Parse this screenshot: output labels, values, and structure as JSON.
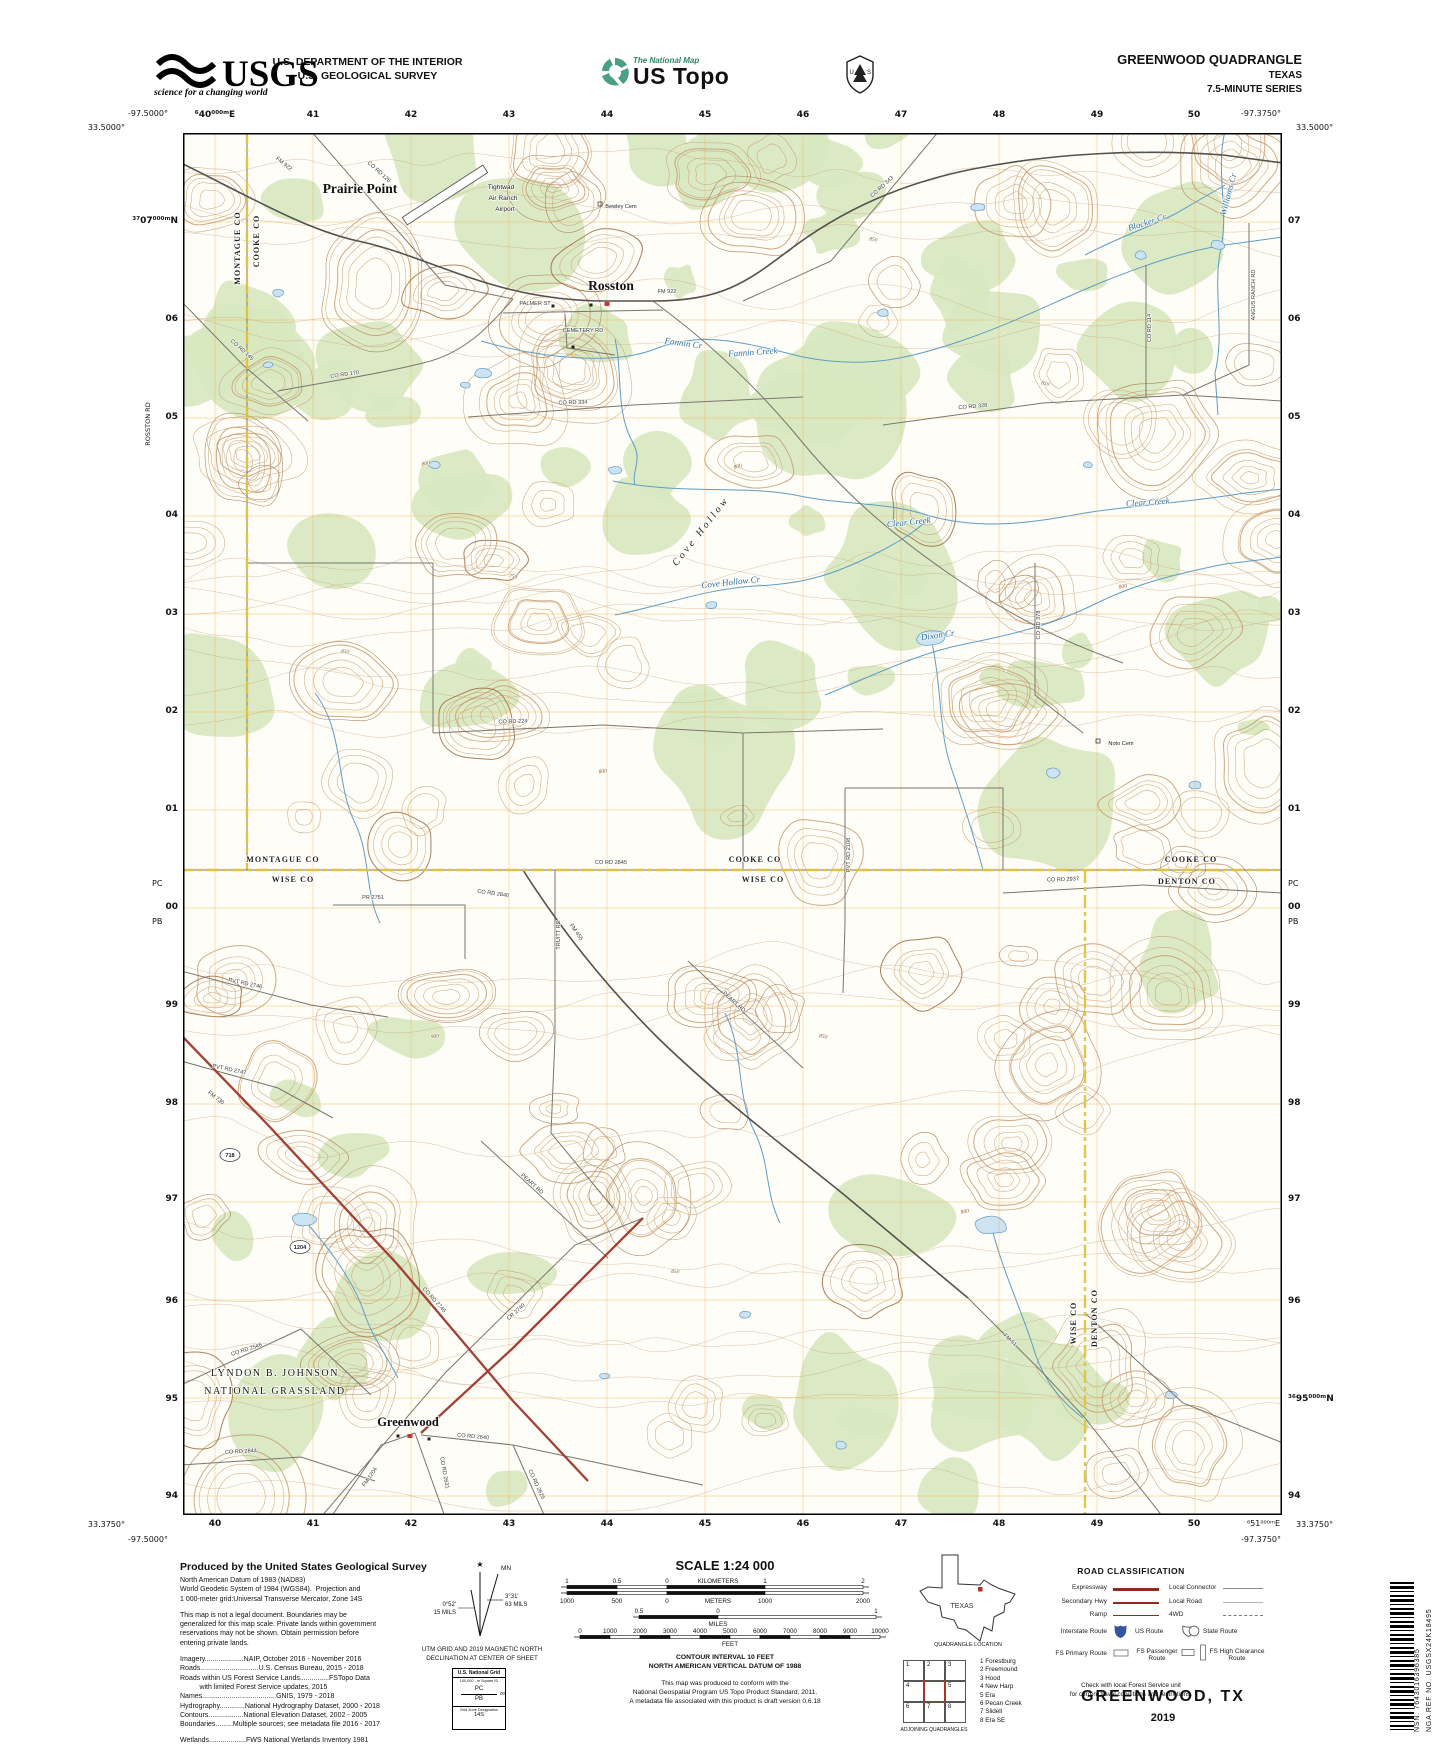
{
  "header": {
    "usgs_wordmark": "USGS",
    "usgs_tagline": "science for a changing world",
    "dept1": "U.S. DEPARTMENT OF THE INTERIOR",
    "dept2": "U.S. GEOLOGICAL SURVEY",
    "natmap_title": "The National Map",
    "natmap_sub": "US Topo",
    "fs_u": "U",
    "fs_s": "S",
    "quad": "GREENWOOD QUADRANGLE",
    "state": "TEXAS",
    "series": "7.5-MINUTE SERIES"
  },
  "collar": {
    "corners": {
      "tl_lat": "33.5000°",
      "tl_lon": "-97.5000°",
      "tr_lat": "33.5000°",
      "tr_lon": "-97.3750°",
      "bl_lat": "33.3750°",
      "bl_lon": "-97.5000°",
      "br_lat": "33.3750°",
      "br_lon": "-97.3750°",
      "br_grid": "⁶51⁰⁰⁰ᵐE"
    },
    "pc": "PC",
    "pb": "PB",
    "rosston_rd": "ROSSTON RD",
    "top": [
      {
        "t": "⁶40⁰⁰⁰ᵐE",
        "x": 215
      },
      {
        "t": "41",
        "x": 313
      },
      {
        "t": "42",
        "x": 411
      },
      {
        "t": "43",
        "x": 509
      },
      {
        "t": "44",
        "x": 607
      },
      {
        "t": "45",
        "x": 705
      },
      {
        "t": "46",
        "x": 803
      },
      {
        "t": "47",
        "x": 901
      },
      {
        "t": "48",
        "x": 999
      },
      {
        "t": "49",
        "x": 1097
      },
      {
        "t": "50",
        "x": 1194
      }
    ],
    "bottom": [
      {
        "t": "40",
        "x": 215
      },
      {
        "t": "41",
        "x": 313
      },
      {
        "t": "42",
        "x": 411
      },
      {
        "t": "43",
        "x": 509
      },
      {
        "t": "44",
        "x": 607
      },
      {
        "t": "45",
        "x": 705
      },
      {
        "t": "46",
        "x": 803
      },
      {
        "t": "47",
        "x": 901
      },
      {
        "t": "48",
        "x": 999
      },
      {
        "t": "49",
        "x": 1097
      },
      {
        "t": "50",
        "x": 1194
      }
    ],
    "left": [
      {
        "t": "³⁷07⁰⁰⁰ᵐN",
        "y": 222
      },
      {
        "t": "06",
        "y": 320
      },
      {
        "t": "05",
        "y": 418
      },
      {
        "t": "04",
        "y": 516
      },
      {
        "t": "03",
        "y": 614
      },
      {
        "t": "02",
        "y": 712
      },
      {
        "t": "01",
        "y": 810
      },
      {
        "t": "00",
        "y": 908
      },
      {
        "t": "99",
        "y": 1006
      },
      {
        "t": "98",
        "y": 1104
      },
      {
        "t": "97",
        "y": 1200
      },
      {
        "t": "96",
        "y": 1302
      },
      {
        "t": "95",
        "y": 1400
      },
      {
        "t": "94",
        "y": 1497
      }
    ],
    "right": [
      {
        "t": "07",
        "y": 222
      },
      {
        "t": "06",
        "y": 320
      },
      {
        "t": "05",
        "y": 418
      },
      {
        "t": "04",
        "y": 516
      },
      {
        "t": "03",
        "y": 614
      },
      {
        "t": "02",
        "y": 712
      },
      {
        "t": "01",
        "y": 810
      },
      {
        "t": "00",
        "y": 908
      },
      {
        "t": "99",
        "y": 1006
      },
      {
        "t": "98",
        "y": 1104
      },
      {
        "t": "97",
        "y": 1200
      },
      {
        "t": "96",
        "y": 1302
      },
      {
        "t": "³⁶95⁰⁰⁰ᵐN",
        "y": 1400
      },
      {
        "t": "94",
        "y": 1497
      }
    ]
  },
  "map": {
    "shields": [
      {
        "t": "718",
        "x": 47,
        "y": 1022
      },
      {
        "t": "1204",
        "x": 117,
        "y": 1114
      }
    ],
    "labels": [
      {
        "t": "Prairie Point",
        "x": 177,
        "y": 60,
        "r": 0,
        "c": "town"
      },
      {
        "t": "Rosston",
        "x": 428,
        "y": 157,
        "r": 0,
        "c": "town"
      },
      {
        "t": "Greenwood",
        "x": 225,
        "y": 1293,
        "r": 0,
        "c": "town2"
      },
      {
        "t": "LYNDON B. JOHNSON",
        "x": 92,
        "y": 1243,
        "r": 0,
        "c": "area"
      },
      {
        "t": "NATIONAL GRASSLAND",
        "x": 92,
        "y": 1261,
        "r": 0,
        "c": "area"
      },
      {
        "t": "Tightwad",
        "x": 318,
        "y": 56,
        "r": 0,
        "c": "site"
      },
      {
        "t": "Air Ranch",
        "x": 320,
        "y": 67,
        "r": 0,
        "c": "site"
      },
      {
        "t": "Airport",
        "x": 322,
        "y": 78,
        "r": 0,
        "c": "site"
      },
      {
        "t": "Bewley Cem",
        "x": 438,
        "y": 75,
        "r": 0,
        "c": "cem"
      },
      {
        "t": "Noto Cem",
        "x": 938,
        "y": 612,
        "r": 0,
        "c": "cem"
      },
      {
        "t": "MONTAGUE CO",
        "x": 57,
        "y": 115,
        "r": -90,
        "c": "county"
      },
      {
        "t": "COOKE CO",
        "x": 76,
        "y": 108,
        "r": -90,
        "c": "county"
      },
      {
        "t": "MONTAGUE CO",
        "x": 100,
        "y": 729,
        "r": 0,
        "c": "county"
      },
      {
        "t": "WISE CO",
        "x": 110,
        "y": 749,
        "r": 0,
        "c": "county"
      },
      {
        "t": "COOKE CO",
        "x": 572,
        "y": 729,
        "r": 0,
        "c": "county"
      },
      {
        "t": "WISE CO",
        "x": 580,
        "y": 749,
        "r": 0,
        "c": "county"
      },
      {
        "t": "COOKE CO",
        "x": 1008,
        "y": 729,
        "r": 0,
        "c": "county"
      },
      {
        "t": "DENTON CO",
        "x": 1004,
        "y": 751,
        "r": 0,
        "c": "county"
      },
      {
        "t": "WISE CO",
        "x": 893,
        "y": 1190,
        "r": -90,
        "c": "county"
      },
      {
        "t": "DENTON CO",
        "x": 914,
        "y": 1185,
        "r": -90,
        "c": "county"
      },
      {
        "t": "Fannin Cr",
        "x": 500,
        "y": 213,
        "r": 8,
        "c": "stream"
      },
      {
        "t": "Fannin Creek",
        "x": 570,
        "y": 222,
        "r": -4,
        "c": "stream"
      },
      {
        "t": "Cove Hollow Cr",
        "x": 548,
        "y": 452,
        "r": -6,
        "c": "stream"
      },
      {
        "t": "Clear Creek",
        "x": 726,
        "y": 392,
        "r": -6,
        "c": "stream"
      },
      {
        "t": "Clear Creek",
        "x": 965,
        "y": 372,
        "r": -4,
        "c": "stream"
      },
      {
        "t": "Dixon Cr",
        "x": 755,
        "y": 505,
        "r": -8,
        "c": "stream"
      },
      {
        "t": "Blocker Cr",
        "x": 965,
        "y": 92,
        "r": -18,
        "c": "stream"
      },
      {
        "t": "Williams Cr",
        "x": 1048,
        "y": 62,
        "r": -75,
        "c": "stream"
      },
      {
        "t": "Cove Hollow",
        "x": 520,
        "y": 400,
        "r": -52,
        "c": "feature"
      },
      {
        "t": "FM 922",
        "x": 100,
        "y": 32,
        "r": 38,
        "c": "road"
      },
      {
        "t": "CO RD 126",
        "x": 195,
        "y": 40,
        "r": 42,
        "c": "road"
      },
      {
        "t": "CO RD 145",
        "x": 58,
        "y": 218,
        "r": 42,
        "c": "road"
      },
      {
        "t": "CO RD 170",
        "x": 162,
        "y": 243,
        "r": -8,
        "c": "road"
      },
      {
        "t": "CO RD 343",
        "x": 700,
        "y": 55,
        "r": -42,
        "c": "road"
      },
      {
        "t": "FM 922",
        "x": 484,
        "y": 160,
        "r": 0,
        "c": "road"
      },
      {
        "t": "PALMER ST",
        "x": 352,
        "y": 172,
        "r": 0,
        "c": "road"
      },
      {
        "t": "CEMETERY RD",
        "x": 400,
        "y": 199,
        "r": 0,
        "c": "road"
      },
      {
        "t": "CO RD 334",
        "x": 390,
        "y": 271,
        "r": -2,
        "c": "road"
      },
      {
        "t": "CO RD 328",
        "x": 790,
        "y": 275,
        "r": -5,
        "c": "road"
      },
      {
        "t": "CO RD 114",
        "x": 968,
        "y": 195,
        "r": -90,
        "c": "road"
      },
      {
        "t": "ANGUS RANCH RD",
        "x": 1072,
        "y": 162,
        "r": -90,
        "c": "road"
      },
      {
        "t": "CO RD 224",
        "x": 330,
        "y": 590,
        "r": -2,
        "c": "road"
      },
      {
        "t": "CO RD 378",
        "x": 857,
        "y": 492,
        "r": -90,
        "c": "road"
      },
      {
        "t": "CO RD 2845",
        "x": 428,
        "y": 731,
        "r": 0,
        "c": "road"
      },
      {
        "t": "TRUITT RD",
        "x": 377,
        "y": 802,
        "r": -90,
        "c": "road"
      },
      {
        "t": "PVT RD 2108",
        "x": 667,
        "y": 722,
        "r": -90,
        "c": "road"
      },
      {
        "t": "CO RD 2937",
        "x": 880,
        "y": 748,
        "r": -2,
        "c": "road"
      },
      {
        "t": "FM 455",
        "x": 392,
        "y": 800,
        "r": 55,
        "c": "road"
      },
      {
        "t": "CO RD 2840",
        "x": 310,
        "y": 762,
        "r": 8,
        "c": "road"
      },
      {
        "t": "PR 2751",
        "x": 190,
        "y": 766,
        "r": 0,
        "c": "road"
      },
      {
        "t": "PVT RD 2746",
        "x": 62,
        "y": 852,
        "r": 12,
        "c": "road"
      },
      {
        "t": "PVT RD 2747",
        "x": 46,
        "y": 938,
        "r": 12,
        "c": "road"
      },
      {
        "t": "FM 730",
        "x": 32,
        "y": 966,
        "r": 38,
        "c": "road"
      },
      {
        "t": "CO RD 2745",
        "x": 250,
        "y": 1168,
        "r": 48,
        "c": "road"
      },
      {
        "t": "PEART RD",
        "x": 550,
        "y": 870,
        "r": 42,
        "c": "road"
      },
      {
        "t": "PEART RD",
        "x": 348,
        "y": 1052,
        "r": 42,
        "c": "road"
      },
      {
        "t": "FM 51",
        "x": 826,
        "y": 1208,
        "r": 42,
        "c": "road"
      },
      {
        "t": "CO RD 2546",
        "x": 64,
        "y": 1218,
        "r": -18,
        "c": "road"
      },
      {
        "t": "CO RD 2844",
        "x": 58,
        "y": 1320,
        "r": -3,
        "c": "road"
      },
      {
        "t": "CR 2740",
        "x": 334,
        "y": 1180,
        "r": -42,
        "c": "road"
      },
      {
        "t": "CO RD 2640",
        "x": 290,
        "y": 1305,
        "r": 5,
        "c": "road"
      },
      {
        "t": "CO RD 2625",
        "x": 352,
        "y": 1352,
        "r": 65,
        "c": "road"
      },
      {
        "t": "FM 1204",
        "x": 188,
        "y": 1345,
        "r": -55,
        "c": "road"
      },
      {
        "t": "CO RD 2631",
        "x": 260,
        "y": 1340,
        "r": 80,
        "c": "road"
      },
      {
        "t": "800",
        "x": 243,
        "y": 332,
        "r": -10,
        "c": "elev"
      },
      {
        "t": "850",
        "x": 690,
        "y": 108,
        "r": 8,
        "c": "elev"
      },
      {
        "t": "800",
        "x": 555,
        "y": 335,
        "r": -12,
        "c": "elev"
      },
      {
        "t": "850",
        "x": 862,
        "y": 252,
        "r": 10,
        "c": "elev"
      },
      {
        "t": "800",
        "x": 940,
        "y": 455,
        "r": -8,
        "c": "elev"
      },
      {
        "t": "850",
        "x": 162,
        "y": 520,
        "r": 6,
        "c": "elev"
      },
      {
        "t": "800",
        "x": 420,
        "y": 640,
        "r": -6,
        "c": "elev"
      },
      {
        "t": "850",
        "x": 640,
        "y": 905,
        "r": 8,
        "c": "elev"
      },
      {
        "t": "900",
        "x": 252,
        "y": 905,
        "r": -6,
        "c": "elev"
      },
      {
        "t": "850",
        "x": 492,
        "y": 1140,
        "r": 6,
        "c": "elev"
      },
      {
        "t": "800",
        "x": 782,
        "y": 1080,
        "r": -8,
        "c": "elev"
      },
      {
        "t": "750",
        "x": 330,
        "y": 445,
        "r": 8,
        "c": "elev"
      }
    ]
  },
  "credits": {
    "lines": [
      {
        "t": "Produced by the United States Geological Survey",
        "b": 1
      },
      {
        "t": "North American Datum of 1983 (NAD83)"
      },
      {
        "t": "World Geodetic System of 1984 (WGS84).  Projection and"
      },
      {
        "t": "1 000-meter grid:Universal Transverse Mercator, Zone 14S"
      },
      {
        "t": "This map is not a legal document. Boundaries may be",
        "gap": 1
      },
      {
        "t": "generalized for this map scale. Private lands within government"
      },
      {
        "t": "reservations may not be shown. Obtain permission before"
      },
      {
        "t": "entering private lands."
      },
      {
        "t": "Imagery....................NAIP, October 2016 - November 2016",
        "gap": 1
      },
      {
        "t": "Roads..............................U.S. Census Bureau, 2015 - 2018"
      },
      {
        "t": "Roads within US Forest Service Lands...............FSTopo Data"
      },
      {
        "t": "          with limited Forest Service updates, 2015"
      },
      {
        "t": "Names......................................GNIS, 1979 - 2018"
      },
      {
        "t": "Hydrography.............National Hydrography Dataset, 2000 - 2018"
      },
      {
        "t": "Contours..................National Elevation Dataset, 2002 - 2005"
      },
      {
        "t": "Boundaries.........Multiple sources; see metadata file 2016 - 2017"
      },
      {
        "t": "Wetlands...................FWS National Wetlands Inventory 1981",
        "gap": 1
      }
    ]
  },
  "declination": {
    "star": "★",
    "mn": "MN",
    "left_deg": "0°52'",
    "left_mils": "15 MILS",
    "right_deg": "3°31'",
    "right_mils": "63 MILS",
    "cap1": "UTM GRID AND 2019 MAGNETIC NORTH",
    "cap2": "DECLINATION AT CENTER OF SHEET"
  },
  "natgrid": {
    "title": "U.S. National Grid",
    "sub": "100,000 - m Square ID",
    "id_top": "PC",
    "id_bottom": "PB",
    "corner": "00",
    "zone_label": "Grid Zone Designation",
    "zone": "14S"
  },
  "scale": {
    "title": "SCALE 1:24 000",
    "contour": "CONTOUR INTERVAL 10 FEET",
    "vdatum": "NORTH AMERICAN VERTICAL DATUM OF 1988",
    "conform1": "This map was produced to conform with the",
    "conform2": "National Geospatial Program US Topo Product Standard, 2011.",
    "conform3": "A metadata file associated with this product is draft version 0.6.18",
    "bars": {
      "kilometers": {
        "label": "KILOMETERS",
        "ticks": [
          {
            "t": "1",
            "x": 567
          },
          {
            "t": "0.5",
            "x": 617
          },
          {
            "t": "0",
            "x": 667
          },
          {
            "t": "1",
            "x": 765
          },
          {
            "t": "2",
            "x": 863
          }
        ]
      },
      "meters": {
        "label": "METERS",
        "ticks": [
          {
            "t": "1000",
            "x": 567
          },
          {
            "t": "500",
            "x": 617
          },
          {
            "t": "0",
            "x": 667
          },
          {
            "t": "1000",
            "x": 765
          },
          {
            "t": "2000",
            "x": 863
          }
        ]
      },
      "miles": {
        "label": "MILES",
        "ticks": [
          {
            "t": "0.5",
            "x": 639
          },
          {
            "t": "0",
            "x": 718
          },
          {
            "t": "1",
            "x": 876
          }
        ]
      },
      "feet": {
        "label": "FEET",
        "ticks": [
          {
            "t": "0",
            "x": 580
          },
          {
            "t": "1000",
            "x": 610
          },
          {
            "t": "2000",
            "x": 640
          },
          {
            "t": "3000",
            "x": 670
          },
          {
            "t": "4000",
            "x": 700
          },
          {
            "t": "5000",
            "x": 730
          },
          {
            "t": "6000",
            "x": 760
          },
          {
            "t": "7000",
            "x": 790
          },
          {
            "t": "8000",
            "x": 820
          },
          {
            "t": "9000",
            "x": 850
          },
          {
            "t": "10000",
            "x": 880
          }
        ]
      }
    }
  },
  "texas": {
    "label": "TEXAS",
    "caption": "QUADRANGLE LOCATION"
  },
  "adjoining": {
    "cells": [
      "1",
      "2",
      "3",
      "4",
      "",
      "5",
      "6",
      "7",
      "8"
    ],
    "names": [
      "1 Forestburg",
      "2 Freemound",
      "3 Hood",
      "4 New Harp",
      "5 Era",
      "6 Pecan Creek",
      "7 Slidell",
      "8 Era SE"
    ],
    "caption": "ADJOINING QUADRANGLES"
  },
  "roadclass": {
    "title": "ROAD CLASSIFICATION",
    "rows": [
      {
        "left": "Expressway",
        "right": "Local Connector"
      },
      {
        "left": "Secondary Hwy",
        "right": "Local Road"
      },
      {
        "left": "Ramp",
        "right": "4WD"
      }
    ],
    "interstate": "Interstate Route",
    "us": "US Route",
    "state": "State Route",
    "fs_primary": "FS Primary Route",
    "fs_passenger": "FS Passenger Route",
    "fs_high": "FS High Clearance Route",
    "note1": "Check with local Forest Service unit",
    "note2": "for current travel conditions and restrictions."
  },
  "footer": {
    "title": "GREENWOOD,  TX",
    "year": "2019"
  },
  "barcode": {
    "nsn": "NSN. 7643016396385",
    "nga": "NGA REF NO. USGSX24K18495"
  }
}
